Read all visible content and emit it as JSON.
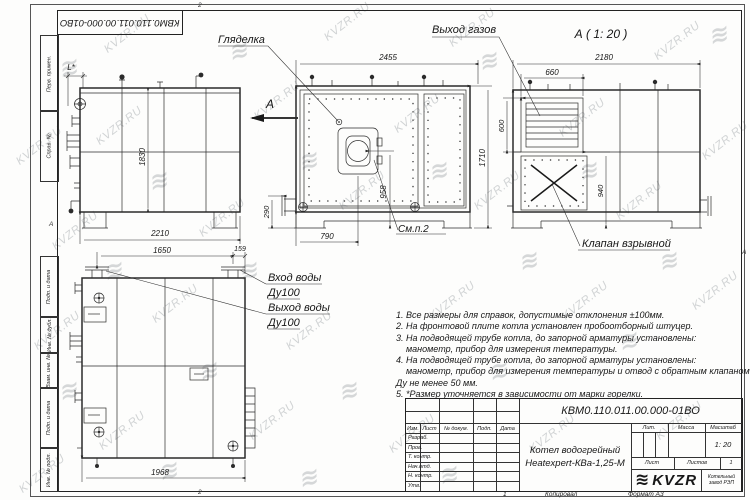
{
  "watermark": {
    "text": "KVZR.RU",
    "logo_glyph": "≋"
  },
  "frame": {
    "doc_number_top": "КВМ0.110.011.00.000-01ВО",
    "zone_top": "2",
    "zone_bottom": "2",
    "zone_left": "А",
    "zone_right": "А",
    "margin_labels": [
      "Перв. примен.",
      "Справ. №",
      "Подп. и дата",
      "Инв. № дубл.",
      "Взам. инв. №",
      "Подп. и дата",
      "Инв. № подл."
    ]
  },
  "views": {
    "side": {
      "section_letter": "А",
      "dims": {
        "L": "L*",
        "height": "1830",
        "width": "2210"
      }
    },
    "front": {
      "callout_peephole": "Гляделка",
      "note_ref": "См.п.2",
      "dims": {
        "width": "2455",
        "height": "1710",
        "burner_v": "958",
        "burner_h": "790",
        "pipe": "290"
      }
    },
    "section": {
      "title": "А ( 1: 20 )",
      "callout_gas": "Выход газов",
      "callout_valve": "Клапан взрывной",
      "dims": {
        "width": "2180",
        "louver_w": "660",
        "louver_h": "600",
        "valve_v": "940"
      }
    },
    "plan": {
      "label_in_1": "Вход воды",
      "label_in_2": "Ду100",
      "label_out_1": "Выход воды",
      "label_out_2": "Ду100",
      "dims": {
        "pipes_span": "1650",
        "pipe_offset": "159",
        "width": "1968"
      }
    }
  },
  "notes": {
    "lines": [
      "1. Все размеры для справок, допустимые отклонения ±100мм.",
      "2. На фронтовой плите котла установлен пробоотборный штуцер.",
      "3. На подводящей трубе котла, до запорной арматуры установлены:",
      "    манометр, прибор для измерения температуры.",
      "4. На подводящей трубе котла, до запорной арматуры установлены:",
      "    манометр, прибор для измерения температуры и отвод с обратным клапаном",
      "Ду не менее 50 мм.",
      "5. *Размер уточняется в зависимости от марки горелки."
    ]
  },
  "titleblock": {
    "doc_number": "КВМ0.110.011.00.000-01ВО",
    "product_line1": "Котел водогрейный",
    "product_line2": "Heatexpert-КВа-1,25-М",
    "col_izm": "Изм.",
    "col_list": "Лист",
    "col_doc": "№ докум.",
    "col_podp": "Подп.",
    "col_data": "Дата",
    "rows": [
      "Разраб.",
      "Пров.",
      "Т. контр.",
      "Нач.отд.",
      "Н. контр.",
      "Утв."
    ],
    "lit": "Лит.",
    "massa": "Масса",
    "scale_label": "Масштаб",
    "scale": "1: 20",
    "sheet_label": "Лист",
    "sheets_label": "Листов",
    "sheets_value": "1",
    "logo_text": "KVZR",
    "org_line1": "Котельный",
    "org_line2": "завод РЭП",
    "footer_num": "1",
    "footer_copied": "Копировал",
    "footer_format": "Формат А3"
  }
}
